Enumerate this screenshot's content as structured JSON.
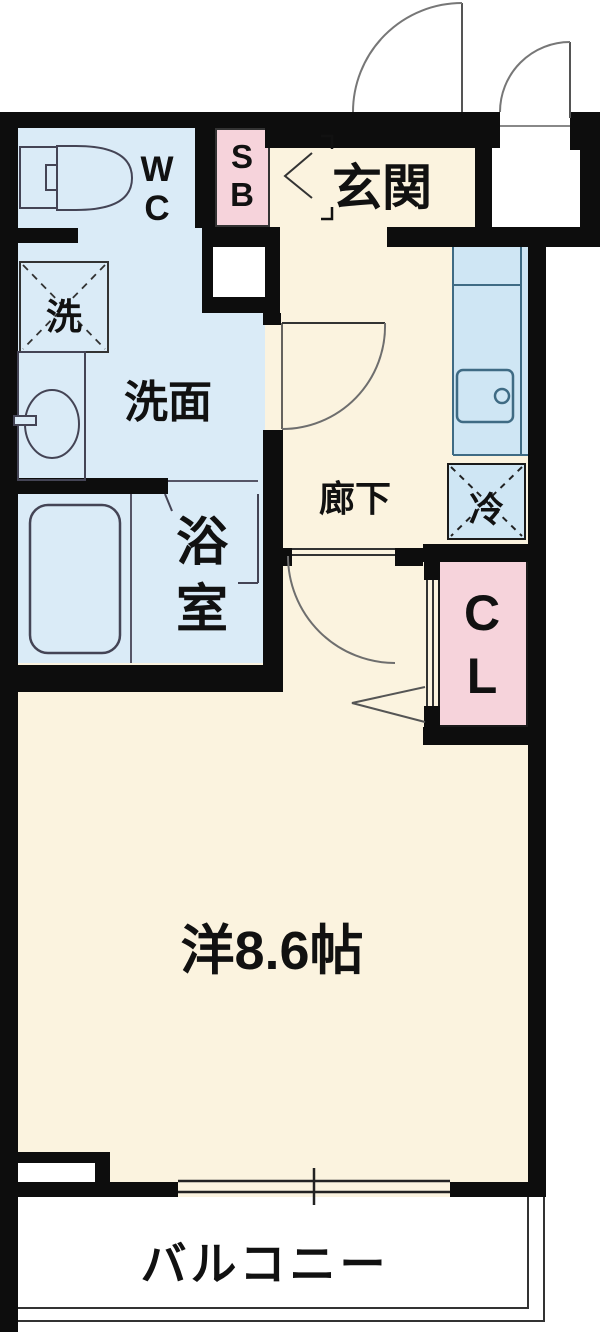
{
  "colors": {
    "wall": "#0d0d0d",
    "cream": "#fbf3df",
    "blue": "#daebf7",
    "kitchen": "#cfe6f4",
    "pink": "#f6d3db",
    "line": "#3c3c3c",
    "arc": "#6e6e6e",
    "fixture": "#44606f"
  },
  "rooms": {
    "genkan": {
      "label": "玄関"
    },
    "wc": {
      "lines": [
        "W",
        "C"
      ]
    },
    "sb": {
      "lines": [
        "S",
        "B"
      ]
    },
    "washer": {
      "label": "洗"
    },
    "senmen": {
      "label": "洗面"
    },
    "yokushitsu": {
      "lines": [
        "浴",
        "室"
      ]
    },
    "rouka": {
      "label": "廊下"
    },
    "rei": {
      "label": "冷"
    },
    "cl": {
      "lines": [
        "C",
        "L"
      ]
    },
    "main": {
      "label": "洋8.6帖"
    },
    "balcony": {
      "label": "バルコニー"
    }
  }
}
